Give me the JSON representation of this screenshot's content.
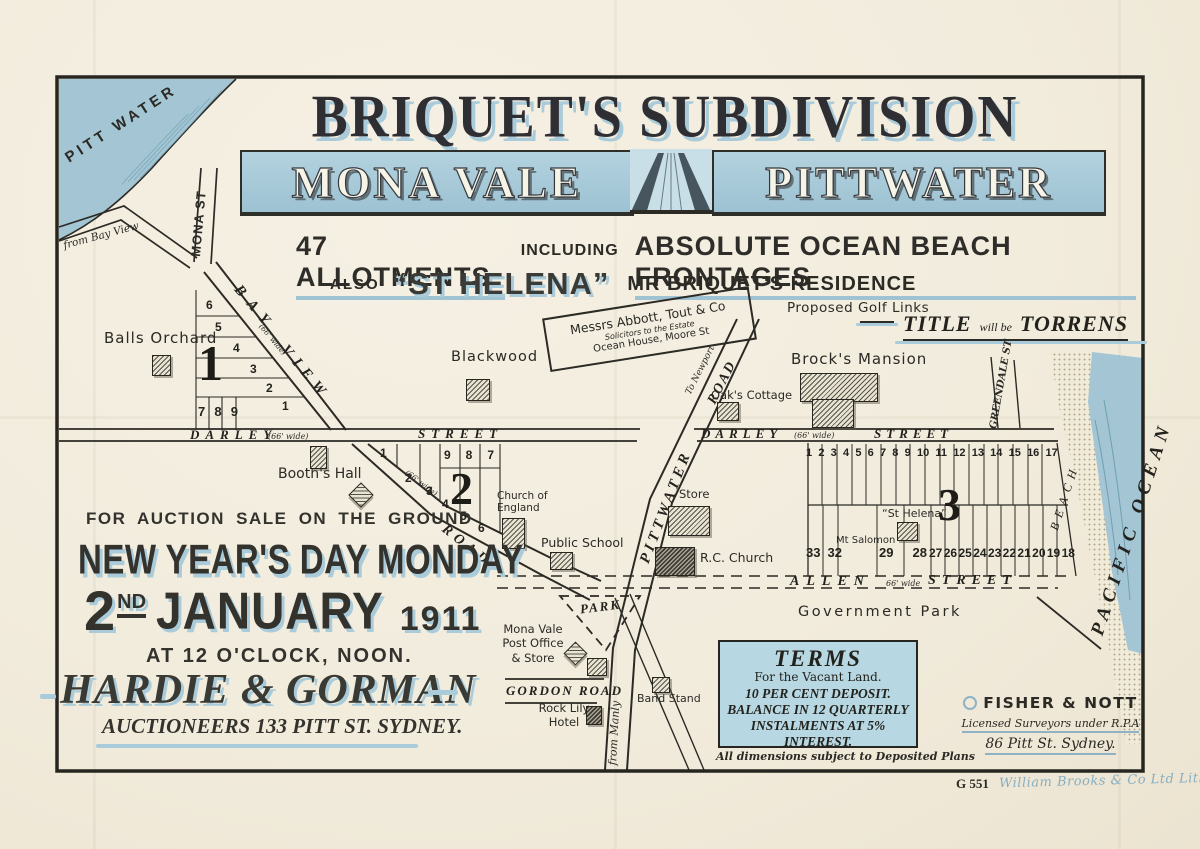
{
  "colors": {
    "paper": "#f2ecdd",
    "ink": "#2b2a25",
    "banner_blue": "#a6c8d8",
    "water_blue": "#a3c5d4",
    "shadow_blue": "#a9cbda",
    "print_blue": "#87aec0"
  },
  "header": {
    "title": "BRIQUET'S SUBDIVISION",
    "banner_left": "MONA VALE",
    "banner_right": "PITTWATER",
    "allotments": "47 ALLOTMENTS",
    "including": "INCLUDING",
    "frontages": "ABSOLUTE OCEAN BEACH FRONTAGES",
    "also": "ALSO",
    "st_helena": "“ST HELENA”",
    "residence": "MR BRIQUET'S RESIDENCE",
    "golf": "Proposed Golf Links",
    "title_word": "TITLE",
    "will_be": "will be",
    "torrens": "TORRENS"
  },
  "auction": {
    "line1": "FOR AUCTION SALE ON THE GROUND",
    "line2": "NEW YEAR'S DAY MONDAY",
    "day": "2",
    "day_sup": "ND",
    "month": "JANUARY",
    "year": "1911",
    "time": "AT 12 O'CLOCK, NOON.",
    "agent": "HARDIE & GORMAN",
    "agent_sub": "AUCTIONEERS 133 PITT ST. SYDNEY."
  },
  "terms": {
    "heading": "TERMS",
    "sub": "For the Vacant Land.",
    "l1": "10 PER CENT DEPOSIT.",
    "l2": "BALANCE IN 12 QUARTERLY",
    "l3": "INSTALMENTS AT 5% INTEREST.",
    "note": "All dimensions subject to Deposited Plans"
  },
  "surveyor": {
    "name": "FISHER & NOTT",
    "line2": "Licensed Surveyors under R.P.A",
    "line3": "86 Pitt St. Sydney."
  },
  "footer": {
    "plate": "G 551",
    "printer": "William Brooks & Co Ltd Litho Syd."
  },
  "map": {
    "water": "PITT WATER",
    "from_bayview": "from Bay View",
    "mona_st": "MONA ST",
    "bay": "BAY",
    "view": "VIEW",
    "road_bv": "ROAD",
    "width_66": "(66' wide)",
    "allen_width": "66' wide",
    "darley": "DARLEY",
    "street": "STREET",
    "pittwater": "PITTWATER",
    "to_newport": "To Newport",
    "road": "ROAD",
    "allen": "ALLEN",
    "gordon": "GORDON ROAD",
    "park": "PARK",
    "govt_park": "Government Park",
    "from_manly": "from Manly",
    "greendale": "GREENDALE ST",
    "beach": "BEACH",
    "pacific_ocean": "PACIFIC OCEAN",
    "sign": {
      "l1": "Messrs Abbott, Tout & Co",
      "l2": "Solicitors to the Estate",
      "l3": "Ocean House, Moore St"
    },
    "places": {
      "balls_orchard": "Balls Orchard",
      "blackwood": "Blackwood",
      "booths_hall": "Booth's Hall",
      "church_1": "Church of",
      "church_2": "England",
      "public_school": "Public School",
      "oaks_cottage": "Oak's Cottage",
      "brocks_mansion": "Brock's Mansion",
      "store": "Store",
      "rc_church": "R.C. Church",
      "st_helena": "“St Helena”",
      "mt_salomon": "Mt Salomon",
      "post_office_1": "Mona Vale",
      "post_office_2": "Post Office",
      "post_office_3": "& Store",
      "band_stand": "Band Stand",
      "rock_lily_1": "Rock Lily",
      "rock_lily_2": "Hotel"
    },
    "sections": {
      "s1": "1",
      "s2": "2",
      "s3": "3"
    },
    "lots": {
      "s1_col": [
        "6",
        "5",
        "4",
        "3",
        "2",
        "1"
      ],
      "s1_row": [
        "7",
        "8",
        "9"
      ],
      "s2_diag": [
        "1",
        "2",
        "3",
        "4",
        "5",
        "6"
      ],
      "s2_row": [
        "9",
        "8",
        "7"
      ],
      "s3_top": [
        "1",
        "2",
        "3",
        "4",
        "5",
        "6",
        "7",
        "8",
        "9",
        "10",
        "11",
        "12",
        "13",
        "14",
        "15",
        "16",
        "17"
      ],
      "s3_bottom_a": [
        "33",
        "32"
      ],
      "s3_bottom_b": [
        "29",
        "28"
      ],
      "s3_bottom_c": [
        "27",
        "26",
        "25",
        "24",
        "23",
        "22",
        "21",
        "20",
        "19",
        "18"
      ]
    }
  }
}
